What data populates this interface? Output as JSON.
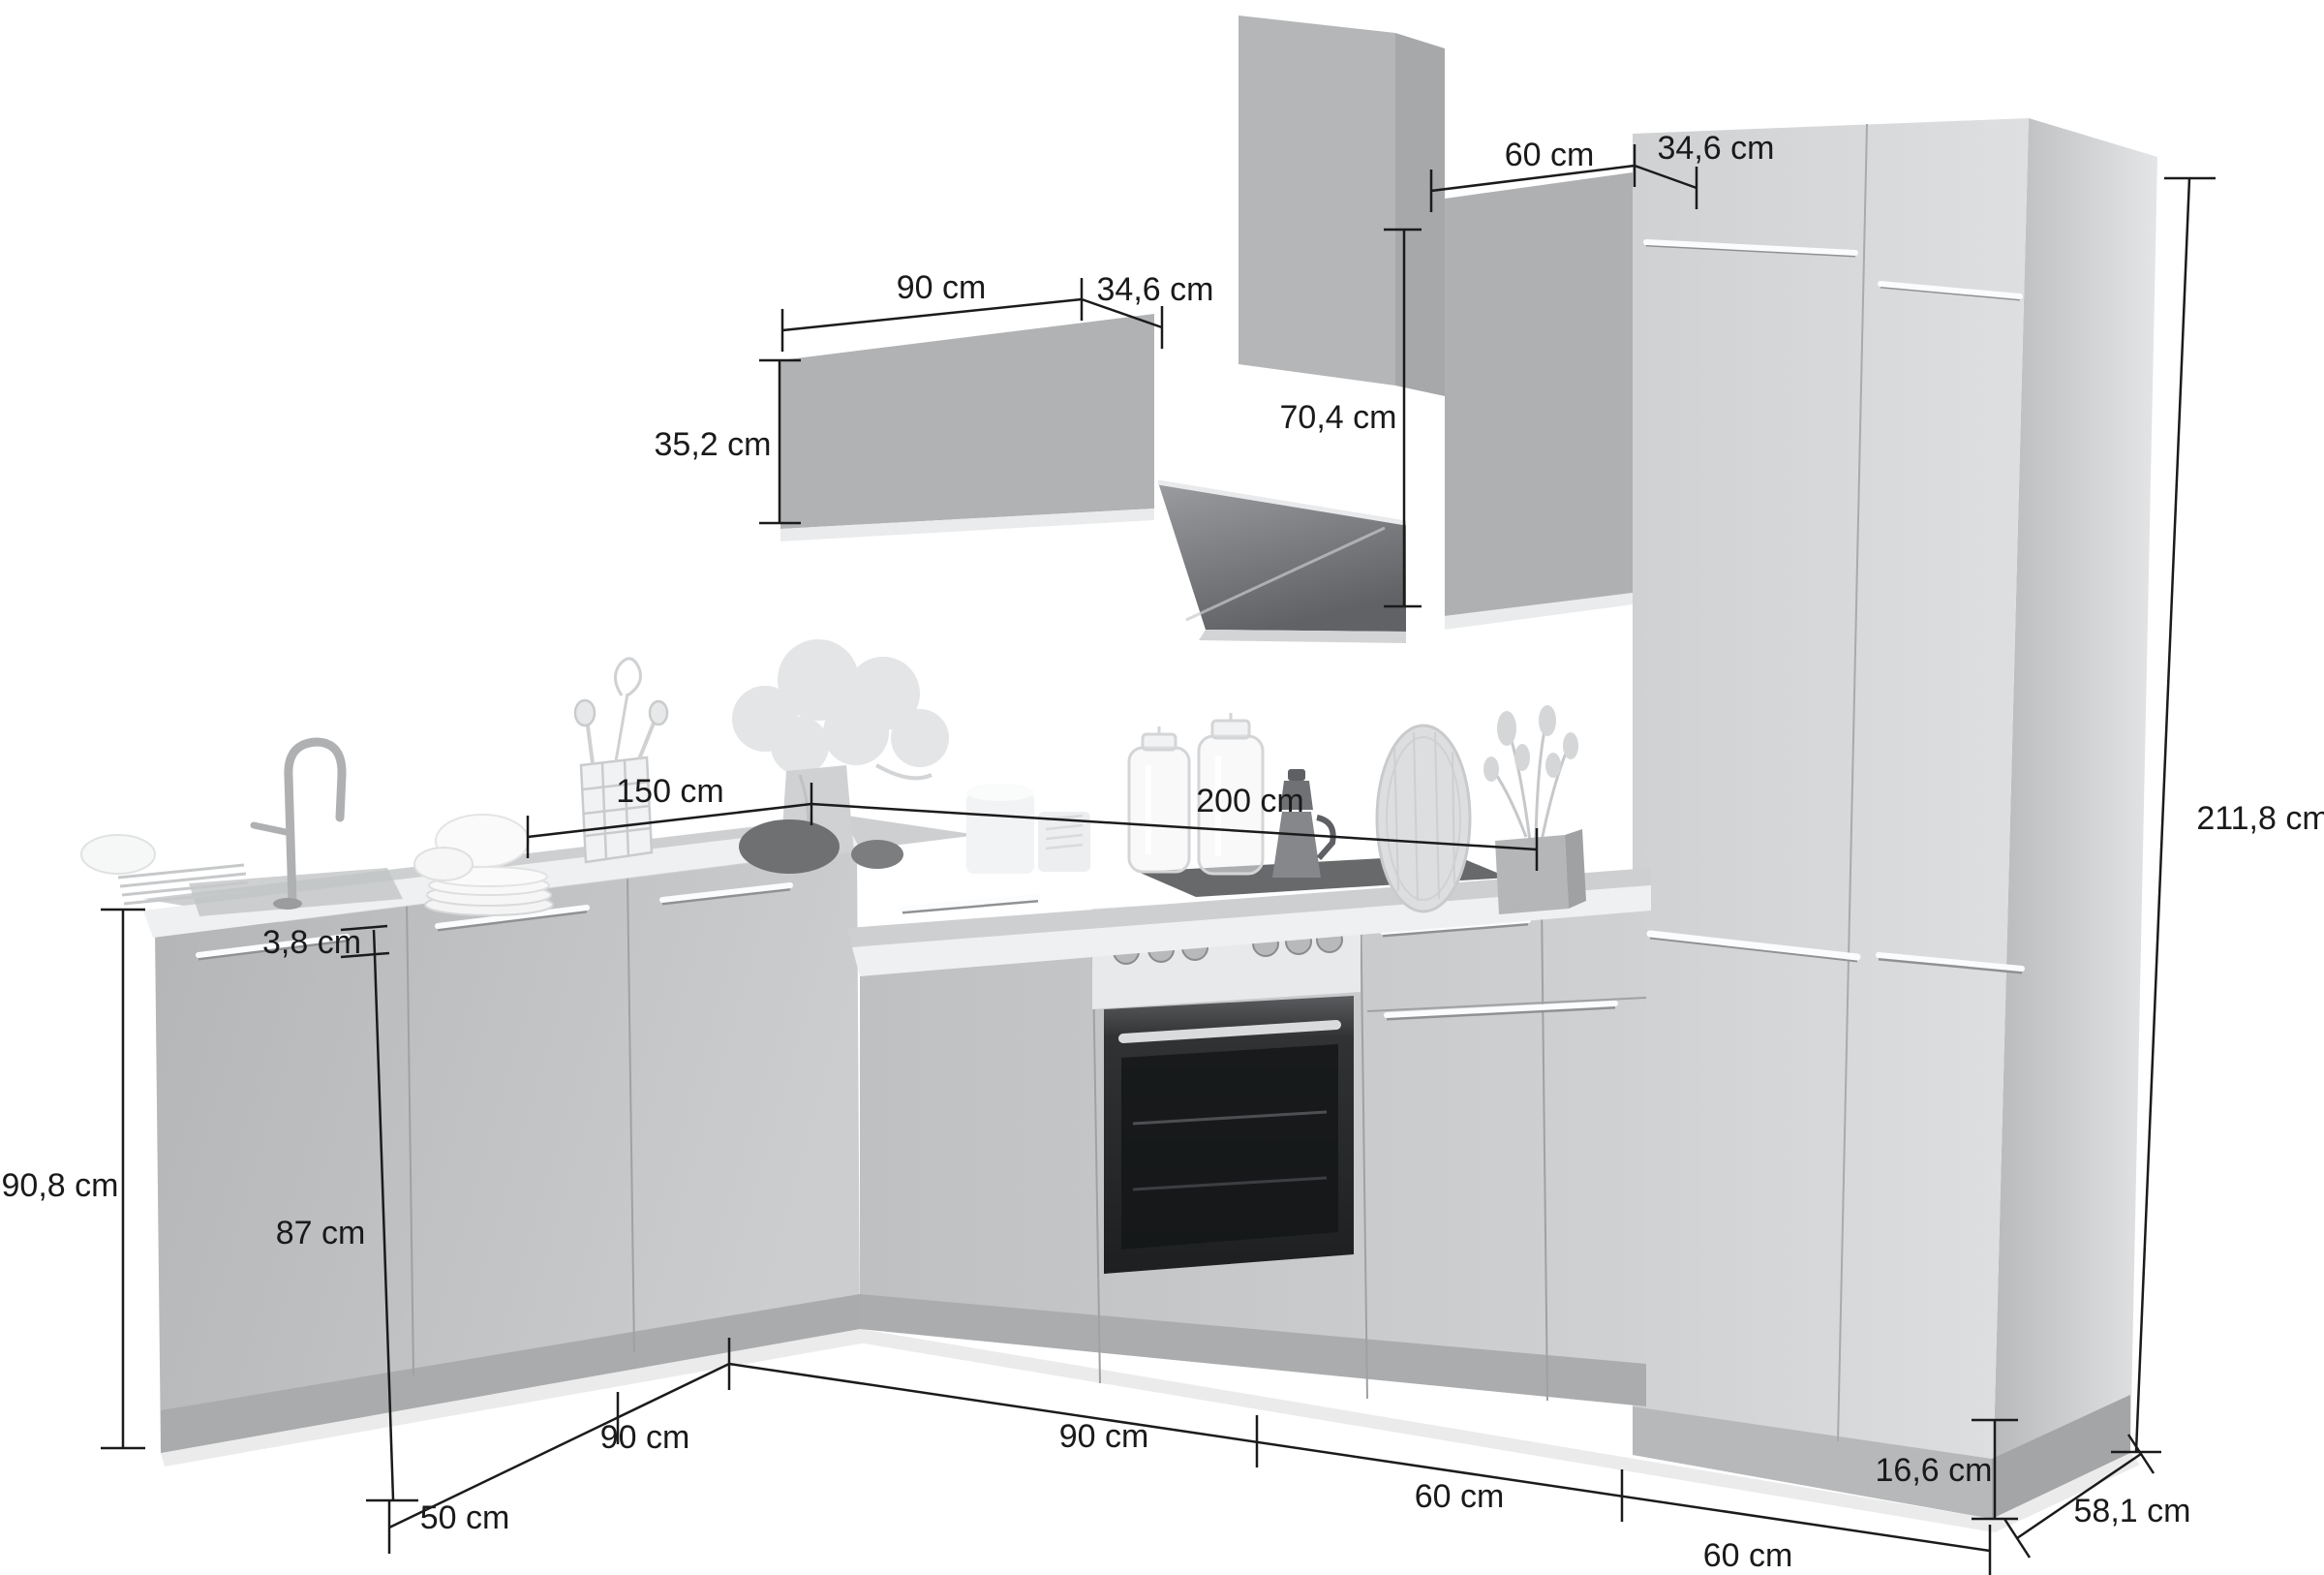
{
  "page": {
    "type": "kitchen-furniture-dimension-diagram",
    "background_color": "#ffffff",
    "unit": "cm"
  },
  "colors": {
    "dimension_line": "#1b1b1b",
    "cabinet_front_light": "#d7d9db",
    "cabinet_front_mid": "#b9bbbd",
    "wall_cabinet": "#b0b2b4",
    "worktop_edge": "#eef0f1",
    "worktop_top": "#cdcfd1",
    "oven_panel": "#e8e9ea",
    "oven_door_dark": "#2e3032"
  },
  "dims": [
    {
      "id": "wall-cabinet-width",
      "label": "90 cm"
    },
    {
      "id": "wall-cabinet-depth",
      "label": "34,6 cm"
    },
    {
      "id": "upper-cabinet-width",
      "label": "60 cm"
    },
    {
      "id": "tall-top-depth",
      "label": "34,6 cm"
    },
    {
      "id": "wall-cabinet-height",
      "label": "35,2 cm"
    },
    {
      "id": "upper-cabinet-height",
      "label": "70,4 cm"
    },
    {
      "id": "tall-unit-height",
      "label": "211,8 cm"
    },
    {
      "id": "left-run-length",
      "label": "150 cm"
    },
    {
      "id": "right-run-length",
      "label": "200 cm"
    },
    {
      "id": "worktop-thickness",
      "label": "3,8 cm"
    },
    {
      "id": "base-cabinet-height",
      "label": "87 cm"
    },
    {
      "id": "base-total-height",
      "label": "90,8 cm"
    },
    {
      "id": "sink-cabinet-width",
      "label": "50 cm"
    },
    {
      "id": "left-corner-width",
      "label": "90 cm"
    },
    {
      "id": "right-corner-width",
      "label": "90 cm"
    },
    {
      "id": "oven-cabinet-width",
      "label": "60 cm"
    },
    {
      "id": "tall-front-width",
      "label": "60 cm"
    },
    {
      "id": "plinth-height",
      "label": "16,6 cm"
    },
    {
      "id": "tall-unit-depth",
      "label": "58,1 cm"
    }
  ]
}
